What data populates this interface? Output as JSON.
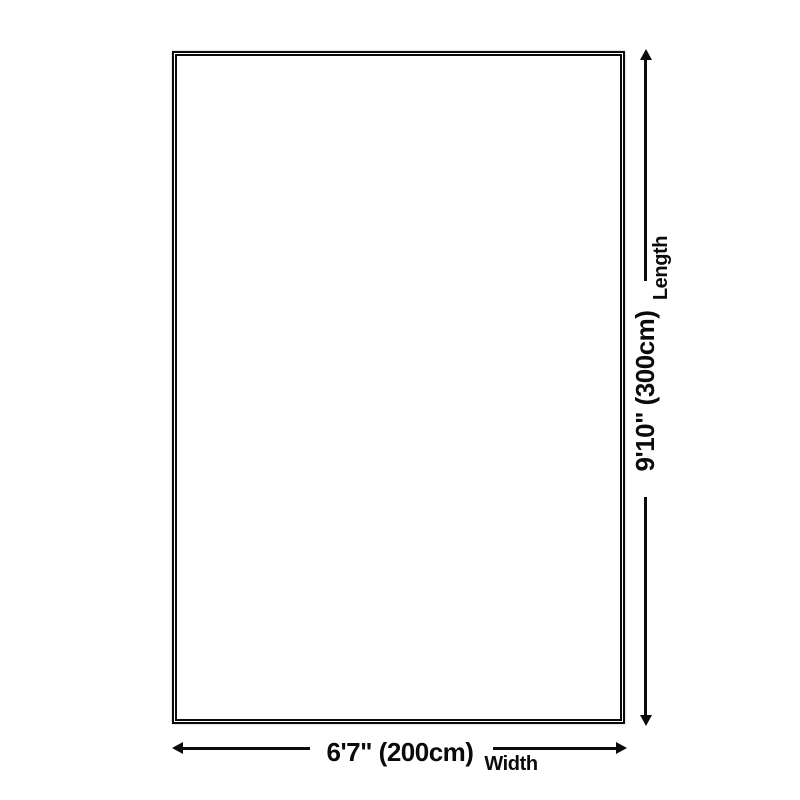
{
  "diagram": {
    "background_color": "#ffffff",
    "line_color": "#0b0b0b",
    "text_color": "#0b0b0b",
    "rug": {
      "shape": "rectangle",
      "border_style": "double"
    },
    "width_dimension": {
      "value": "6'7\" (200cm)",
      "label": "Width"
    },
    "length_dimension": {
      "value": "9'10\" (300cm)",
      "label": "Length"
    }
  }
}
